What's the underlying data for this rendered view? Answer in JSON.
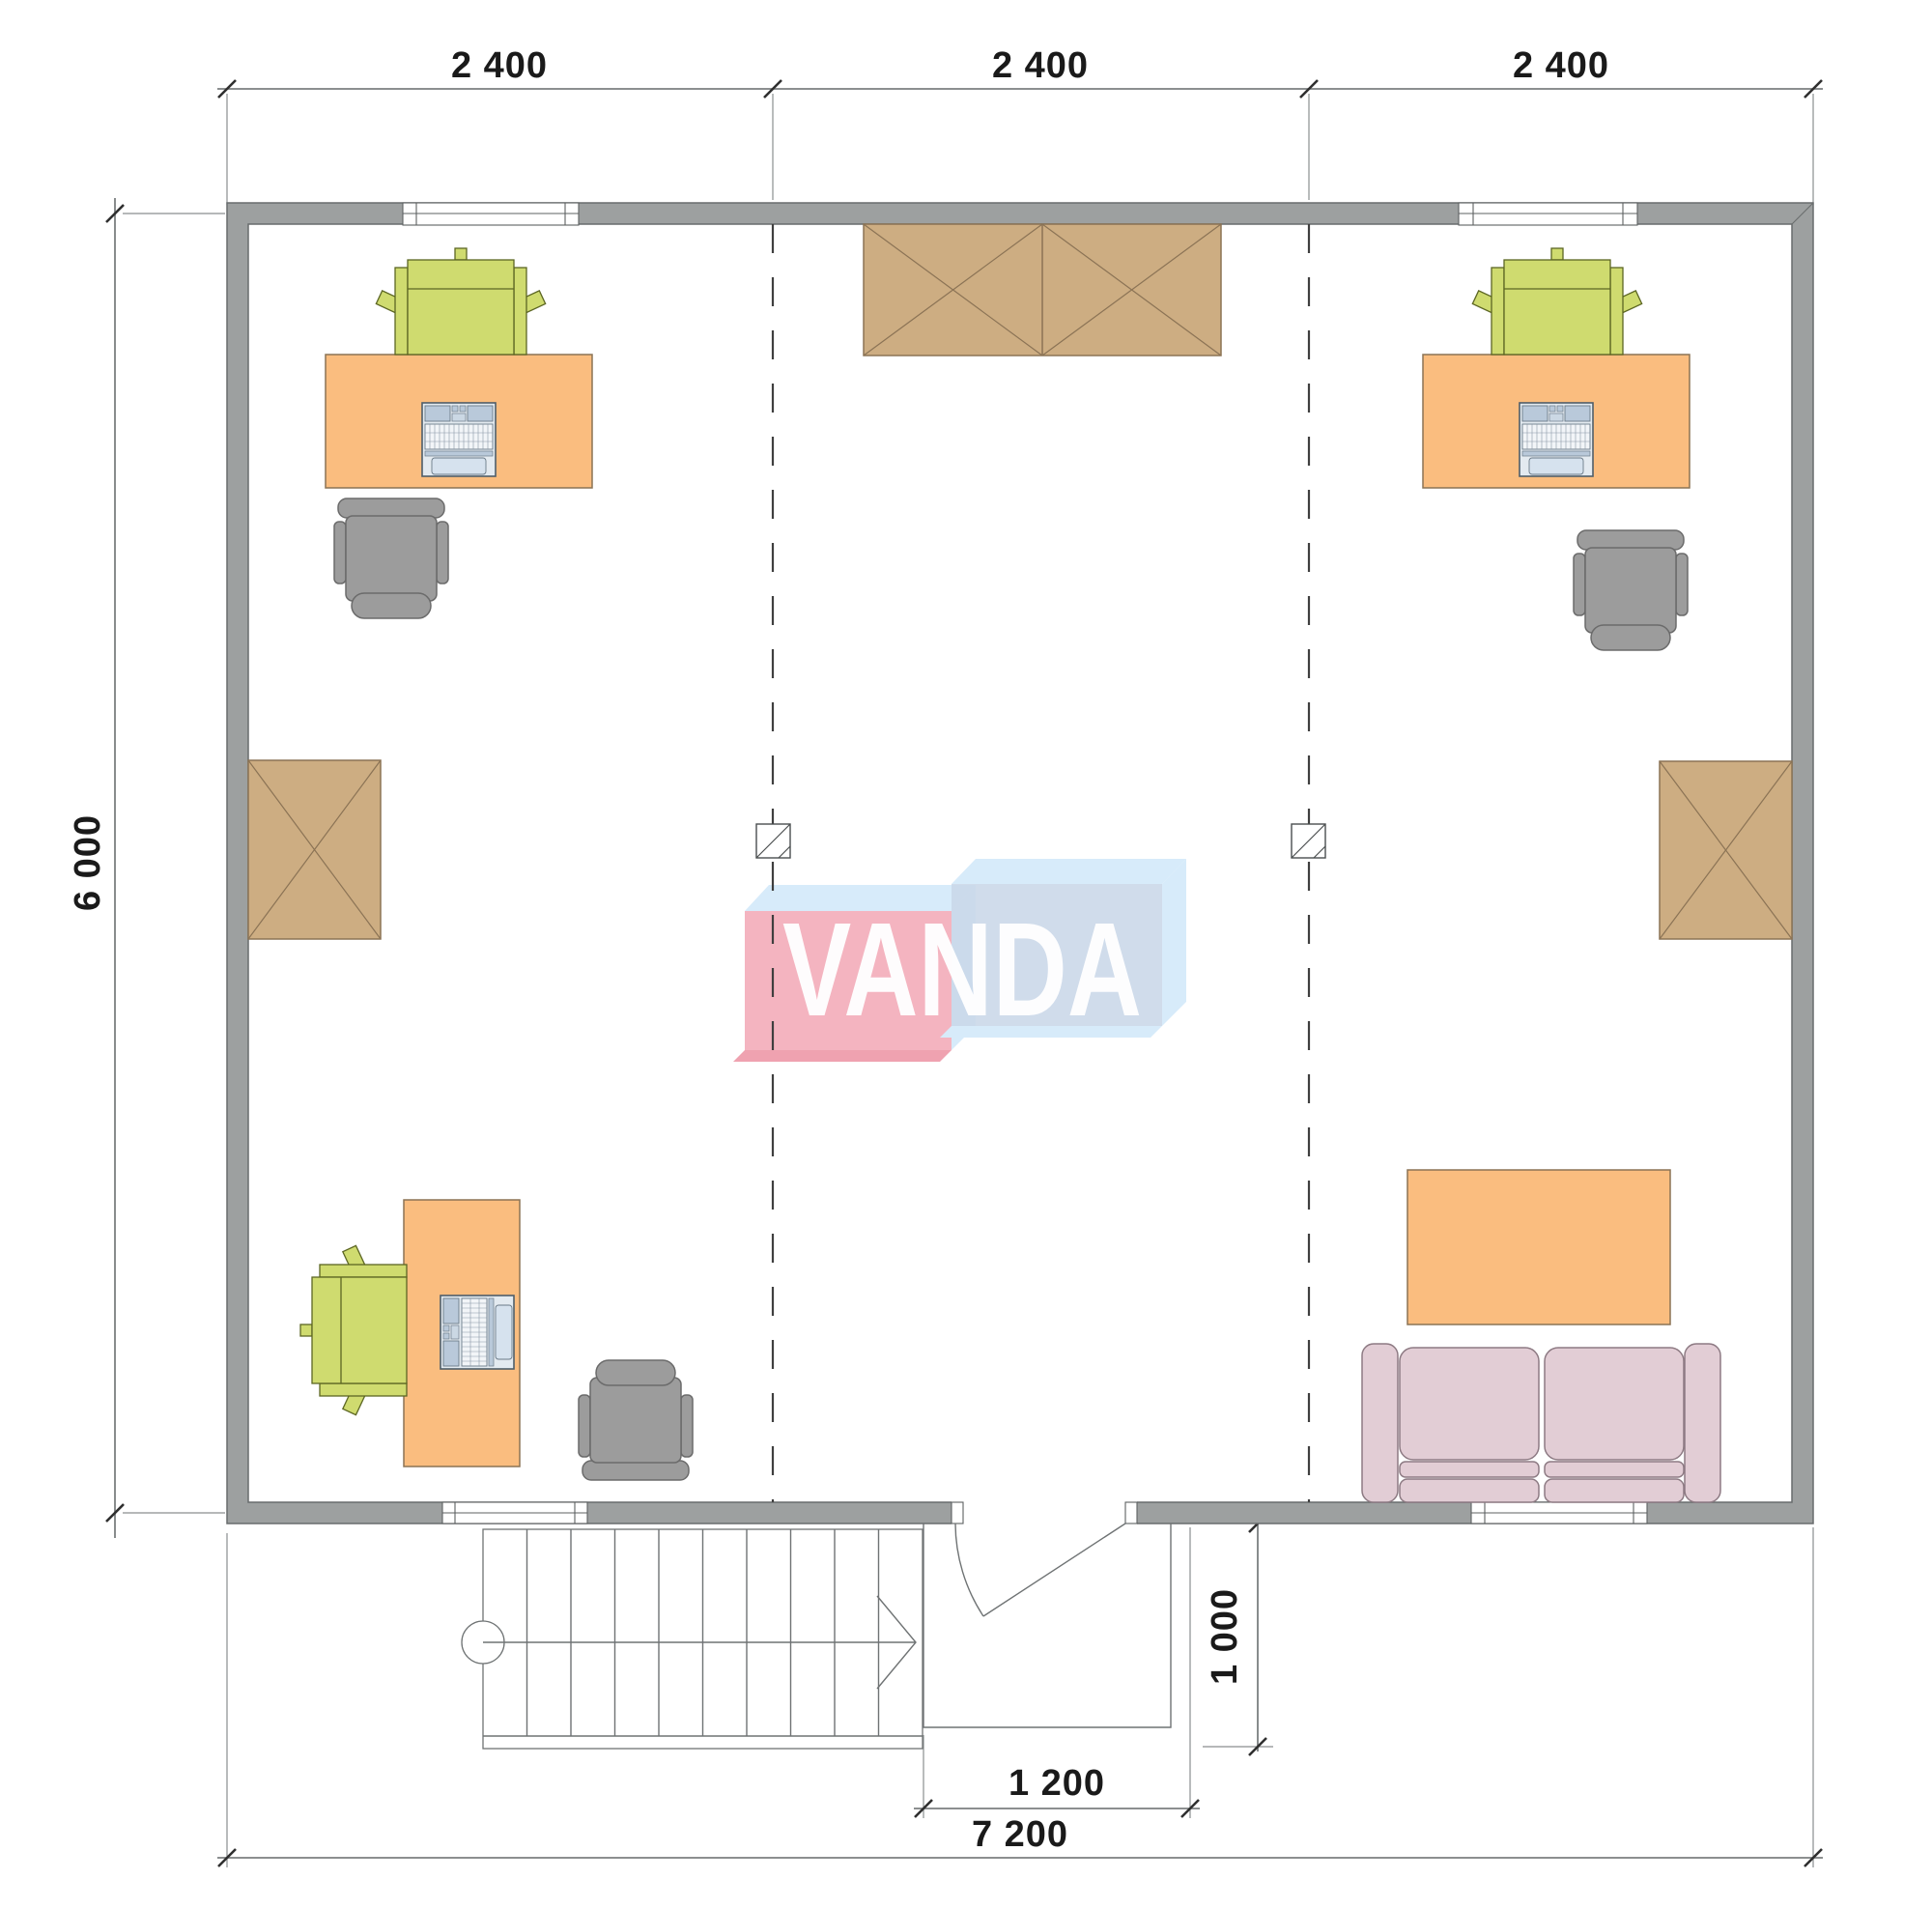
{
  "drawing": {
    "type": "architectural-floor-plan",
    "logo": {
      "text": "VANDA"
    },
    "dims": {
      "top": [
        "2 400",
        "2 400",
        "2 400"
      ],
      "left": "6 000",
      "overall_width": "7 200",
      "entry_width": "1 200",
      "porch_depth": "1 000"
    },
    "colors": {
      "wall": "#9DA0A0",
      "wall_stroke": "#686C6D",
      "desk": "#FABD7F",
      "desk_stroke": "#8B7355",
      "chair_green": "#CFDB6F",
      "chair_green_stroke": "#5C6623",
      "office_chair": "#9C9C9C",
      "office_chair_stroke": "#6B6B6B",
      "storage": "#CDAD82",
      "storage_stroke": "#8B7355",
      "sofa": "#E2CDD5",
      "sofa_stroke": "#8D7A83",
      "logo_pink": "#F4B4C0",
      "logo_pink_shadow": "#EFA2B0",
      "logo_blue": "#C9D7E8",
      "logo_face": "#D7EBFA",
      "laptop_body": "#E3EAF0",
      "laptop_panel": "#B9C9DA"
    }
  }
}
